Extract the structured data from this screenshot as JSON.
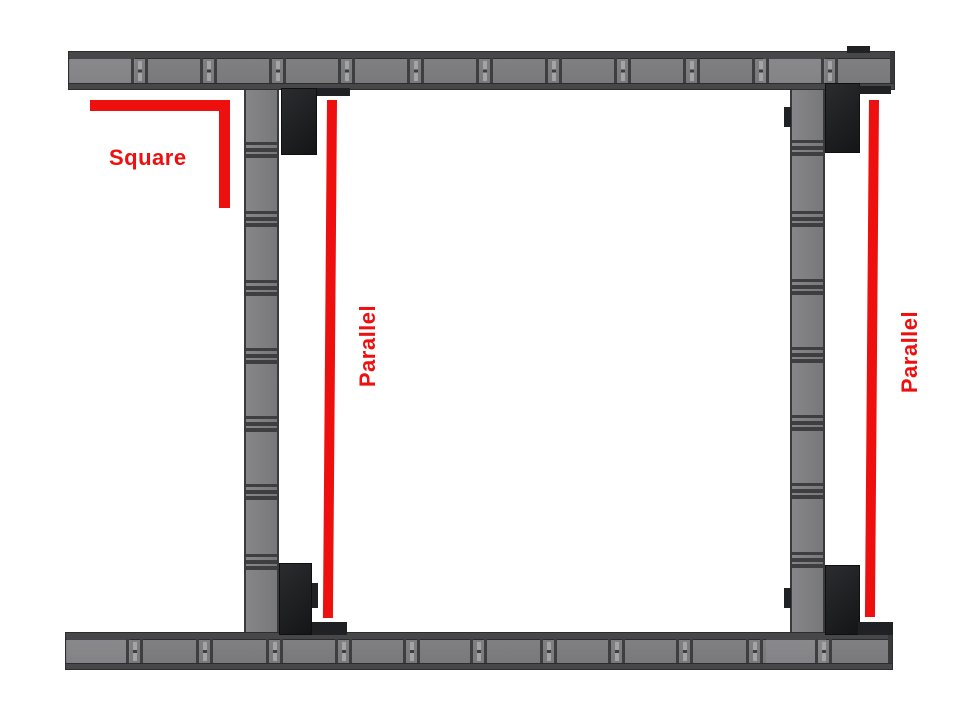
{
  "annotations": {
    "square": {
      "label": "Square"
    },
    "parallel_left": {
      "label": "Parallel"
    },
    "parallel_right": {
      "label": "Parallel"
    }
  },
  "colors": {
    "annotation_red": "#ee0f0f",
    "channel_gray": "#7d7d80",
    "channel_edge_dark": "#47474a",
    "divider_dark": "#3e3e41",
    "slot_light": "#a3a4a6",
    "gusset_black": "#1d1e21",
    "background": "#ffffff"
  }
}
